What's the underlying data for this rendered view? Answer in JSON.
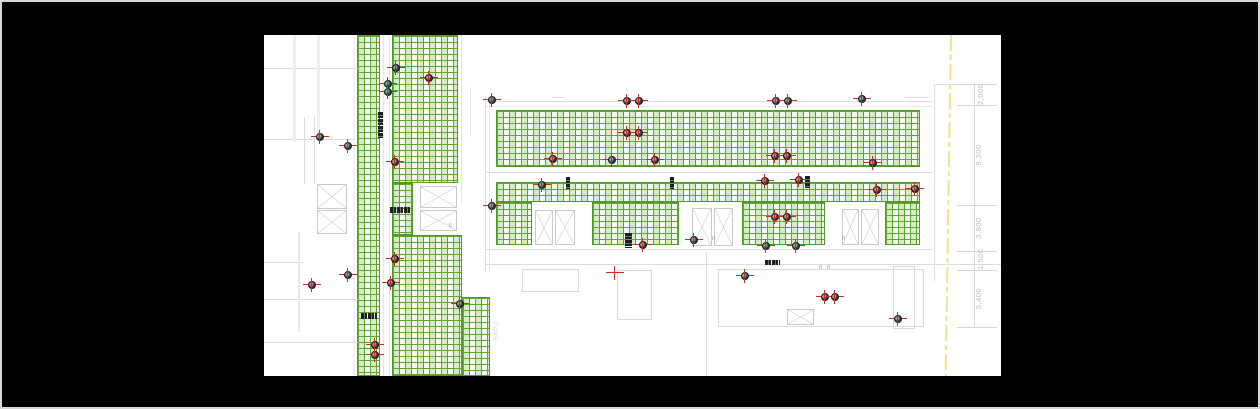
{
  "window": {
    "background": "#000000",
    "border_color": "#d8d8d8",
    "canvas": {
      "left": 262,
      "top": 33,
      "width": 737,
      "height": 341,
      "background": "#ffffff"
    }
  },
  "palette": {
    "grid_line_green": "#5ca32e",
    "grid_fill_green": "#f6fbf1",
    "wall_gray": "#dcdcdc",
    "marker_red": "#c03028",
    "marker_dot": "#343434",
    "dim_text_gray": "#bcbcbc",
    "boundary_yellow": "#f2e289"
  },
  "layers": {
    "grids": [
      [
        93,
        0,
        23,
        341
      ],
      [
        128,
        0,
        66,
        148
      ],
      [
        128,
        148,
        21,
        52
      ],
      [
        128,
        200,
        70,
        141
      ],
      [
        198,
        262,
        28,
        79
      ],
      [
        232,
        75,
        424,
        57
      ],
      [
        232,
        147,
        424,
        20
      ],
      [
        232,
        167,
        36,
        43
      ],
      [
        328,
        167,
        87,
        43
      ],
      [
        478,
        167,
        83,
        43
      ],
      [
        621,
        167,
        35,
        43
      ]
    ],
    "walls": [
      [
        119,
        0,
        1,
        341,
        "#e7e7e7"
      ],
      [
        125,
        0,
        1,
        341,
        "#e7e7e7"
      ],
      [
        90,
        0,
        1,
        341,
        "#ececec"
      ],
      [
        197,
        0,
        1,
        167,
        "#e7e7e7"
      ],
      [
        0,
        33,
        94,
        1
      ],
      [
        0,
        104,
        90,
        1
      ],
      [
        0,
        227,
        40,
        1
      ],
      [
        0,
        264,
        94,
        1
      ],
      [
        0,
        307,
        94,
        1
      ],
      [
        29,
        0,
        3,
        107,
        "#efefef"
      ],
      [
        53,
        0,
        3,
        107,
        "#efefef"
      ],
      [
        40,
        82,
        1,
        67
      ],
      [
        50,
        82,
        1,
        67
      ],
      [
        34,
        197,
        2,
        100,
        "#e7e7e7"
      ],
      [
        221,
        66,
        447,
        1
      ],
      [
        221,
        71,
        447,
        1,
        "#e7e7e7"
      ],
      [
        288,
        62,
        12,
        1
      ],
      [
        641,
        62,
        24,
        1
      ],
      [
        670,
        49,
        1,
        197
      ],
      [
        670,
        49,
        43,
        1
      ],
      [
        221,
        137,
        447,
        1
      ],
      [
        221,
        214,
        447,
        1
      ],
      [
        221,
        229,
        516,
        1
      ],
      [
        442,
        217,
        1,
        124
      ],
      [
        206,
        52,
        1,
        50,
        "#e7e7e7"
      ],
      [
        221,
        62,
        1,
        175
      ],
      [
        225,
        62,
        1,
        175,
        "#e7e7e7"
      ],
      [
        693,
        49,
        40,
        1,
        "#d6d6d6"
      ],
      [
        693,
        70,
        40,
        1,
        "#d6d6d6"
      ],
      [
        693,
        170,
        40,
        1,
        "#d6d6d6"
      ],
      [
        693,
        216,
        40,
        1,
        "#d6d6d6"
      ],
      [
        693,
        235,
        40,
        1,
        "#d6d6d6"
      ],
      [
        693,
        292,
        40,
        1,
        "#d6d6d6"
      ],
      [
        710,
        49,
        1,
        243,
        "#d6d6d6"
      ]
    ],
    "rects": [
      [
        454,
        234,
        206,
        58
      ],
      [
        629,
        231,
        22,
        63
      ],
      [
        258,
        234,
        57,
        23
      ],
      [
        353,
        235,
        35,
        50
      ]
    ],
    "skylights": [
      [
        53,
        149,
        30,
        25
      ],
      [
        53,
        175,
        30,
        24
      ],
      [
        156,
        151,
        37,
        22
      ],
      [
        156,
        175,
        37,
        21
      ],
      [
        271,
        175,
        18,
        35
      ],
      [
        291,
        175,
        20,
        35
      ],
      [
        428,
        173,
        20,
        38
      ],
      [
        450,
        173,
        19,
        38
      ],
      [
        578,
        174,
        17,
        36
      ],
      [
        597,
        174,
        18,
        36
      ],
      [
        523,
        274,
        27,
        16
      ]
    ],
    "markers": [
      [
        132,
        33,
        "d"
      ],
      [
        165,
        43,
        "d"
      ],
      [
        124,
        49,
        "d"
      ],
      [
        124,
        57,
        "d"
      ],
      [
        56,
        102,
        "d"
      ],
      [
        84,
        111,
        "d"
      ],
      [
        131,
        127,
        "d"
      ],
      [
        228,
        65,
        "d"
      ],
      [
        363,
        66,
        "d"
      ],
      [
        375,
        66,
        "d"
      ],
      [
        363,
        98,
        "d"
      ],
      [
        375,
        98,
        "d"
      ],
      [
        289,
        124,
        "d"
      ],
      [
        348,
        125,
        "d"
      ],
      [
        391,
        125,
        "d"
      ],
      [
        278,
        150,
        "d"
      ],
      [
        512,
        66,
        "d"
      ],
      [
        524,
        66,
        "d"
      ],
      [
        598,
        64,
        "d"
      ],
      [
        511,
        121,
        "d"
      ],
      [
        523,
        121,
        "d"
      ],
      [
        609,
        128,
        "d"
      ],
      [
        501,
        146,
        "d"
      ],
      [
        535,
        145,
        "d"
      ],
      [
        651,
        154,
        "d"
      ],
      [
        613,
        155,
        "d"
      ],
      [
        228,
        171,
        "d"
      ],
      [
        131,
        224,
        "d"
      ],
      [
        127,
        248,
        "d"
      ],
      [
        84,
        240,
        "d"
      ],
      [
        48,
        250,
        "d"
      ],
      [
        196,
        269,
        "d"
      ],
      [
        111,
        310,
        "d"
      ],
      [
        111,
        320,
        "d"
      ],
      [
        430,
        205,
        "d"
      ],
      [
        379,
        210,
        "d"
      ],
      [
        351,
        238,
        "r"
      ],
      [
        511,
        182,
        "d"
      ],
      [
        523,
        182,
        "d"
      ],
      [
        502,
        211,
        "d"
      ],
      [
        532,
        211,
        "d"
      ],
      [
        481,
        241,
        "d"
      ],
      [
        561,
        262,
        "d"
      ],
      [
        571,
        262,
        "d"
      ],
      [
        634,
        284,
        "d"
      ]
    ],
    "tags": [
      [
        114,
        77,
        5,
        26,
        "v"
      ],
      [
        126,
        172,
        20,
        6,
        "h"
      ],
      [
        97,
        278,
        16,
        6,
        "h"
      ],
      [
        361,
        198,
        7,
        15,
        "v"
      ],
      [
        501,
        225,
        15,
        5,
        "h"
      ],
      [
        541,
        141,
        5,
        12,
        "v"
      ],
      [
        302,
        142,
        4,
        12,
        "v"
      ],
      [
        406,
        142,
        4,
        12,
        "v"
      ]
    ],
    "glyphs": [
      {
        "t": "c",
        "x": 185,
        "y": 188
      },
      {
        "t": "n",
        "x": 448,
        "y": 201
      },
      {
        "t": "n",
        "x": 578,
        "y": 201
      },
      {
        "t": "n",
        "x": 555,
        "y": 230
      },
      {
        "t": "n",
        "x": 563,
        "y": 230
      }
    ],
    "boundary": {
      "x": 686,
      "width": 2,
      "tilt_deg": 0.9,
      "color": "#f2e289"
    },
    "dimensions": [
      {
        "text": "2,000",
        "x": 712,
        "bottom": 70,
        "len": 21
      },
      {
        "text": "9,300",
        "x": 710,
        "bottom": 170,
        "len": 100
      },
      {
        "text": "3,800",
        "x": 710,
        "bottom": 216,
        "len": 46
      },
      {
        "text": "1,500",
        "x": 712,
        "bottom": 235,
        "len": 19
      },
      {
        "text": "5,400",
        "x": 710,
        "bottom": 292,
        "len": 57
      }
    ],
    "joint_label": {
      "text": "EXP.J",
      "x": 230,
      "y": 305
    }
  }
}
